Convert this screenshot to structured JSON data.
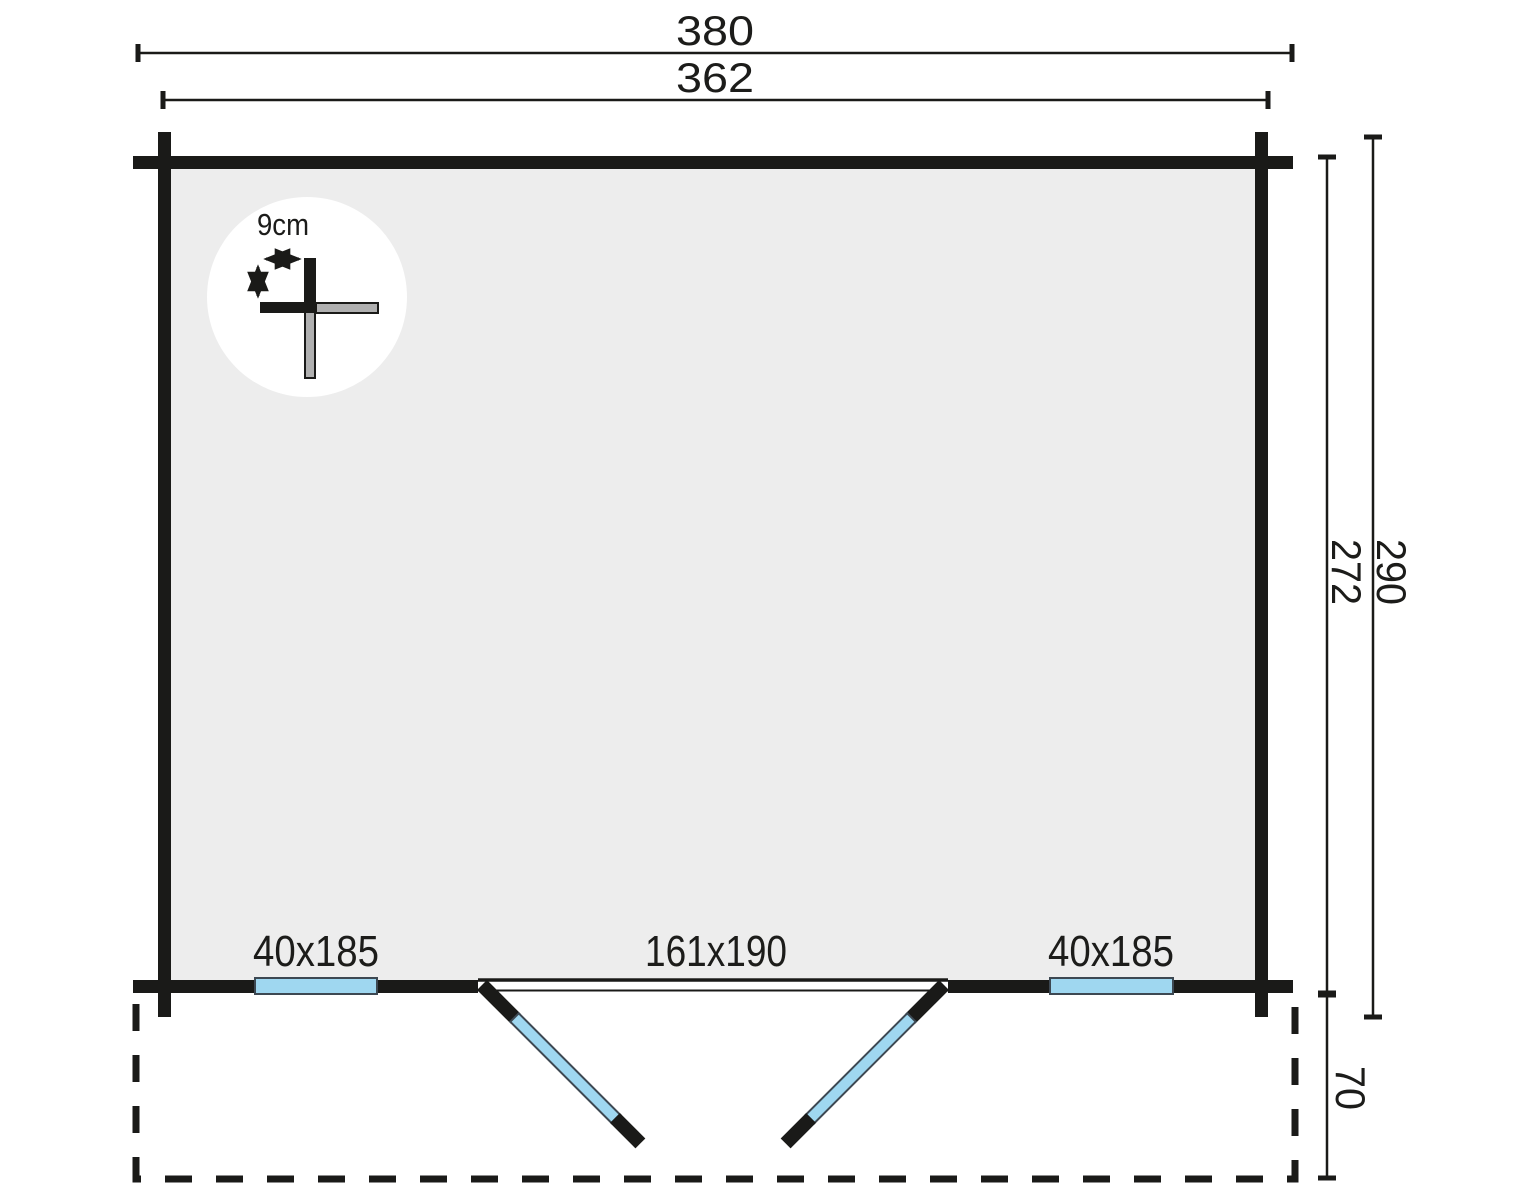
{
  "plan": {
    "dimensions": {
      "outer_width": "380",
      "inner_width": "362",
      "inner_depth": "272",
      "outer_depth": "290",
      "terrace_depth": "70"
    },
    "detail": {
      "log_thickness_label": "9cm"
    },
    "openings": {
      "window_left_label": "40x185",
      "door_label": "161x190",
      "window_right_label": "40x185"
    },
    "colors": {
      "wall": "#1a1a18",
      "interior_fill": "#ededed",
      "glazing_blue": "#9fd7f0",
      "log_gray": "#b0b0b0"
    }
  }
}
